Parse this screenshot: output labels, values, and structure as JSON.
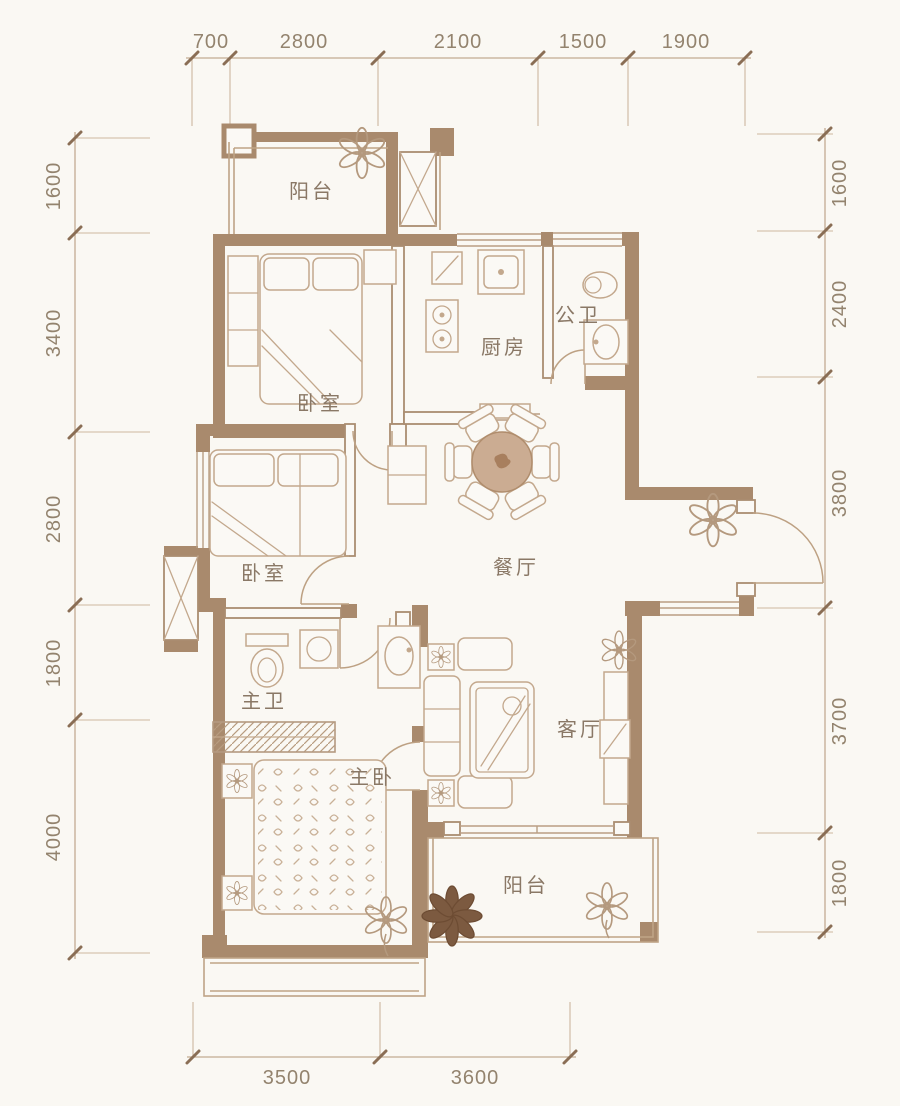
{
  "page": {
    "type": "residential floor plan drawing"
  },
  "colors": {
    "background": "#faf8f3",
    "wall": "#a98a6d",
    "furniture_line": "#c3a88d",
    "dimension_line": "#c2aa92",
    "dimension_text": "#93836e",
    "room_text": "#8a7866",
    "dining_table_fill": "#cbac92",
    "dark_plant": "#7c5a40"
  },
  "dimensions": {
    "top": [
      "700",
      "2800",
      "2100",
      "1500",
      "1900"
    ],
    "left": [
      "1600",
      "3400",
      "2800",
      "1800",
      "4000"
    ],
    "right": [
      "1600",
      "2400",
      "3800",
      "3700",
      "1800"
    ],
    "bottom": [
      "3500",
      "3600"
    ]
  },
  "rooms": {
    "balcony_top": "阳台",
    "bedroom_top": "卧室",
    "kitchen": "厨房",
    "guest_bath": "公卫",
    "dining": "餐厅",
    "bedroom_mid": "卧室",
    "master_bath": "主卫",
    "living": "客厅",
    "master_bedroom": "主卧",
    "balcony_bottom": "阳台"
  }
}
